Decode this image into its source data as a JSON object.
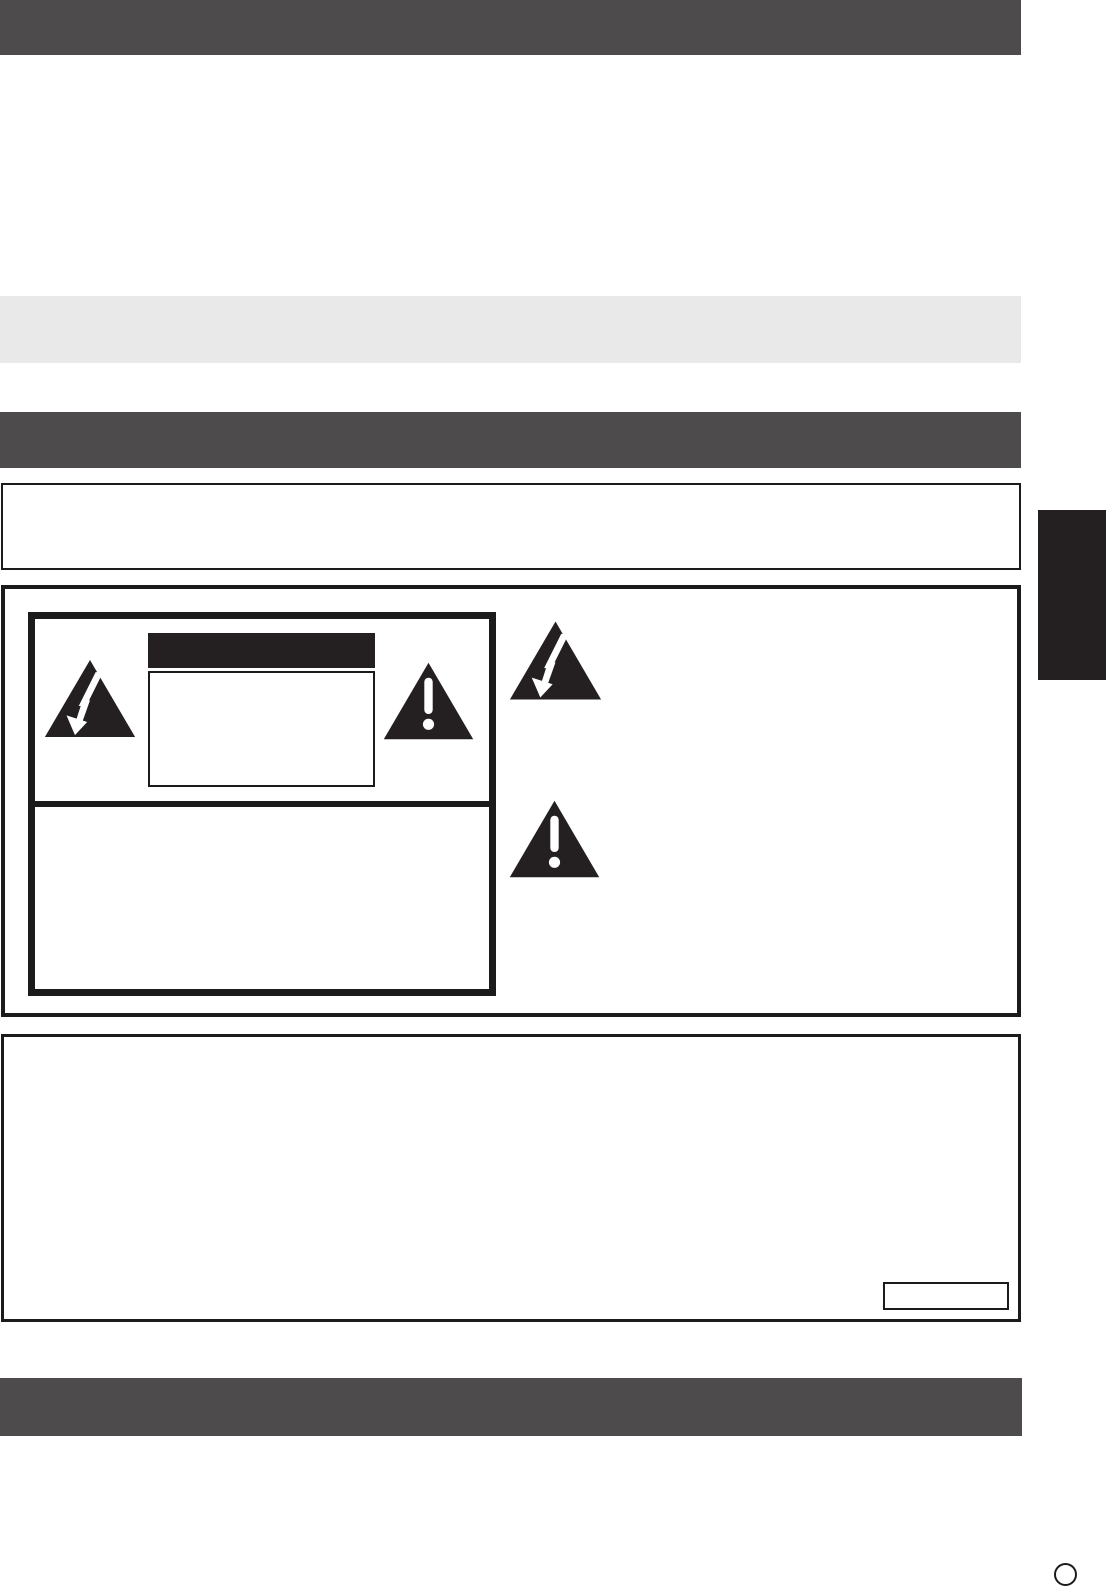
{
  "page": {
    "kind": "manual-safety-page-template",
    "visible_text": ""
  },
  "colors": {
    "page_bg": "#ffffff",
    "banner": "#4d4b4c",
    "band": "#e9e9e9",
    "ink": "#242021",
    "border": "#1b1b1b",
    "symbol_fg": "#ffffff"
  },
  "icons": {
    "high_voltage": "lightning-bolt-in-triangle",
    "caution": "exclamation-in-triangle"
  }
}
